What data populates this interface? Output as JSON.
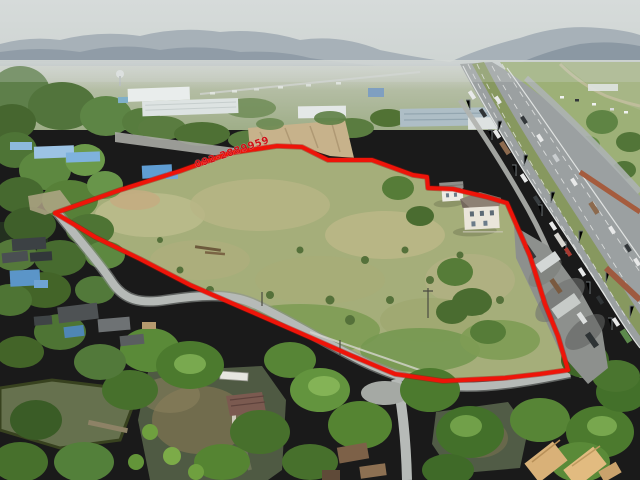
{
  "image": {
    "kind": "aerial-drone-photo",
    "subject": "Vacant land plot for sale outlined in red beside a multi-lane highway; village houses, ponds and dense trees in the foreground; industrial warehouses, hazy fields and mountains on the horizon",
    "width_px": 640,
    "height_px": 480
  },
  "annotation": {
    "phone_label": "092-2889959",
    "text_color": "#cf1318",
    "rotation_deg": -19
  },
  "boundary": {
    "color": "#ee1409",
    "stroke_width": 4,
    "points": "55,213 120,190 180,171 230,153 277,146 302,147 312,152 328,160 372,160 413,175 427,177 428,188 453,189 487,197 507,203 517,226 530,256 545,304 558,336 568,370 540,374 505,378 443,381 395,374 350,355 300,333 245,309 190,285 140,259 95,237"
  },
  "palette": {
    "sky": "#d3d8d7",
    "mountains": "#93a0a9",
    "haze": "#ccd1cb",
    "distant_fields": "#a9b493",
    "plot_grass": "#a5ae7a",
    "dry_grass": "#bdb88a",
    "tree_dark": "#47702c",
    "tree_light": "#6f9f45",
    "highway_asphalt": "#9ba0a1",
    "median_grass": "#87985f",
    "lane_marking": "#e8eae9",
    "village_road": "#b6bab7",
    "pond_water": "#4f5a43",
    "roof_blue": "#5f9dd3",
    "roof_tan": "#d9b178",
    "roof_orange": "#b05036",
    "barrier_wall_orange": "#a55c3e",
    "house_white": "#eae5da",
    "truck_yard_concrete": "#8d908d"
  }
}
